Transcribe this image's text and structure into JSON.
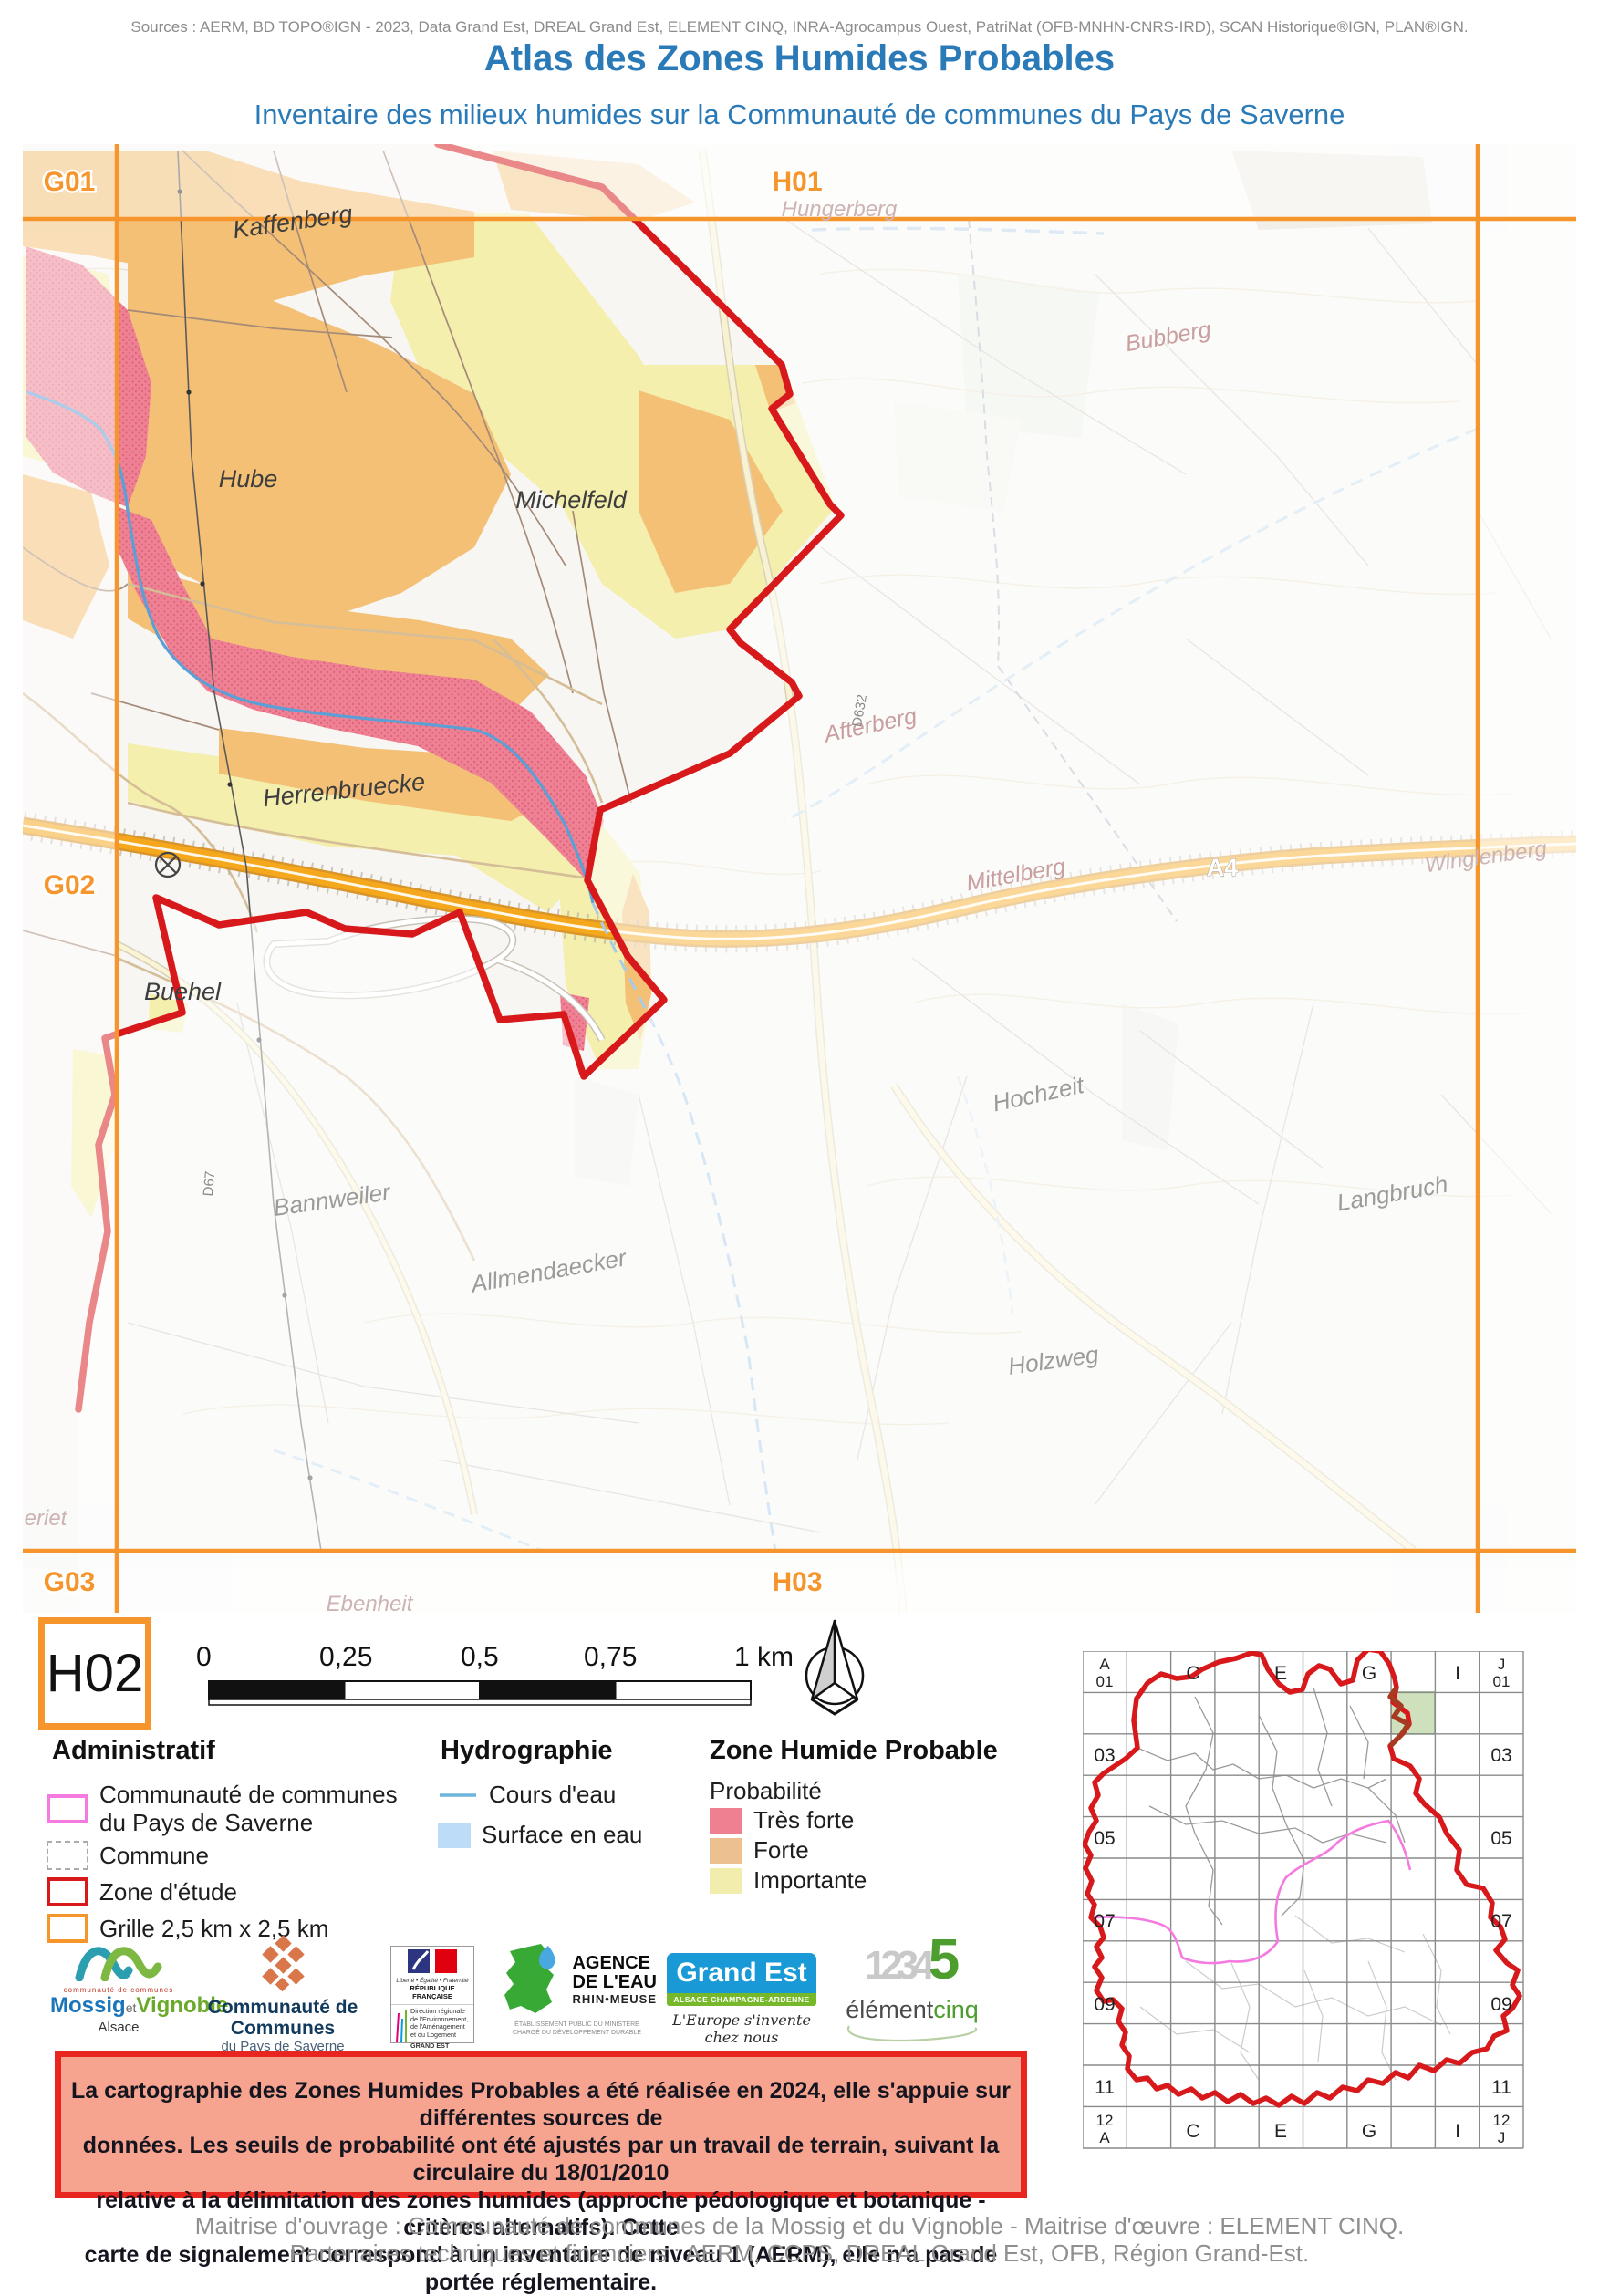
{
  "header": {
    "sources": "Sources : AERM, BD TOPO®IGN - 2023, Data Grand Est, DREAL Grand Est, ELEMENT CINQ, INRA-Agrocampus Ouest, PatriNat (OFB-MNHN-CNRS-IRD), SCAN Historique®IGN, PLAN®IGN.",
    "title": "Atlas des Zones Humides Probables",
    "subtitle": "Inventaire des milieux humides sur la Communauté de communes du Pays de Saverne"
  },
  "map": {
    "grid_labels": [
      {
        "text": "G01"
      },
      {
        "text": "H01"
      },
      {
        "text": "G02"
      },
      {
        "text": "G03"
      },
      {
        "text": "H03"
      }
    ],
    "place_labels": [
      {
        "text": "Kaffenberg"
      },
      {
        "text": "Hube"
      },
      {
        "text": "Michelfeld"
      },
      {
        "text": "Herrenbruecke"
      },
      {
        "text": "Buehel"
      },
      {
        "text": "Bannweiler"
      },
      {
        "text": "Allmendaecker"
      },
      {
        "text": "Hochzeit"
      },
      {
        "text": "Langbruch"
      },
      {
        "text": "Holzweg"
      },
      {
        "text": "Afterberg"
      },
      {
        "text": "Mittelberg"
      },
      {
        "text": "Bubberg"
      },
      {
        "text": "Hungerberg"
      },
      {
        "text": "Winglenberg"
      },
      {
        "text": "Ebenheit"
      },
      {
        "text": "eriet"
      }
    ],
    "road_labels": [
      {
        "text": "A4"
      },
      {
        "text": "D632"
      },
      {
        "text": "D67"
      }
    ]
  },
  "grid_ref": "H02",
  "scale_bar": {
    "ticks": [
      "0",
      "0,25",
      "0,5",
      "0,75",
      "1 km"
    ]
  },
  "legend": {
    "administratif": {
      "title": "Administratif",
      "cc_line1": "Communauté de communes",
      "cc_line2": "du Pays de Saverne",
      "commune": "Commune",
      "zone": "Zone d'étude",
      "grille": "Grille 2,5 km x 2,5 km"
    },
    "hydrographie": {
      "title": "Hydrographie",
      "cours": "Cours d'eau",
      "surface": "Surface en eau"
    },
    "zone_humide": {
      "title": "Zone Humide Probable",
      "subtitle": "Probabilité",
      "items": [
        {
          "label": "Très forte",
          "color": "#ee8092"
        },
        {
          "label": "Forte",
          "color": "#ecc08f"
        },
        {
          "label": "Importante",
          "color": "#f2ecad"
        }
      ]
    }
  },
  "logos": {
    "mossig": {
      "top": "communauté de communes",
      "name1": "Mossig",
      "et": "et",
      "name2": "Vignoble",
      "region": "Alsace"
    },
    "saverne": {
      "line1": "Communauté de Communes",
      "line2": "du Pays de Saverne"
    },
    "dreal": {
      "motto": "Liberté • Égalité • Fraternité",
      "republic": "RÉPUBLIQUE FRANÇAISE",
      "l1": "Direction régionale",
      "l2": "de l'Environnement,",
      "l3": "de l'Aménagement",
      "l4": "et du Logement",
      "region": "GRAND EST"
    },
    "agence": {
      "l1": "AGENCE",
      "l2": "DE L'EAU",
      "l3": "RHIN•MEUSE",
      "sub1": "ÉTABLISSEMENT PUBLIC DU MINISTÈRE",
      "sub2": "CHARGÉ DU DÉVELOPPEMENT DURABLE"
    },
    "grandest": {
      "name": "Grand Est",
      "strip": "ALSACE CHAMPAGNE-ARDENNE LORRAINE",
      "script": "L'Europe s'invente chez nous"
    },
    "element5": {
      "digits": "1234",
      "five": "5",
      "word1": "élément",
      "word2": "cinq"
    }
  },
  "warning": {
    "line1": "La cartographie des Zones Humides Probables a été réalisée en 2024, elle s'appuie sur différentes sources de",
    "line2": "données. Les seuils de probabilité ont été ajustés par un travail de terrain, suivant la circulaire du 18/01/2010",
    "line3": "relative à la délimitation des zones humides (approche pédologique et botanique - critères alternatifs). Cette",
    "line4": "carte de signalement correspond à un inventaire de niveau 1 (AERM), elle n'a pas de portée réglementaire."
  },
  "overview": {
    "row_labels": [
      "03",
      "05",
      "07",
      "09",
      "11"
    ],
    "col_labels": [
      "C",
      "E",
      "G",
      "I"
    ],
    "corner_tl": [
      "A",
      "01"
    ],
    "corner_tr": [
      "J",
      "01"
    ],
    "corner_bl": [
      "12",
      "A"
    ],
    "corner_br": [
      "12",
      "J"
    ]
  },
  "footer": {
    "line1": "Maitrise d'ouvrage : Communauté de communes de la Mossig et du Vignoble - Maitrise d'œuvre : ELEMENT CINQ.",
    "line2": "Partenaires techniques et financiers : AERM, CCPS, DREAL Grand Est, OFB, Région Grand-Est."
  },
  "colors": {
    "accent_blue": "#2a7ab8",
    "grid_orange": "#f5952c",
    "study_red": "#d7191c",
    "tres_forte": "#ee8092",
    "forte": "#f3c076",
    "importante": "#f4efad",
    "stream_blue": "#5b9fd6",
    "cc_magenta": "#f57ae0",
    "warning_fill": "#f6a38f"
  }
}
